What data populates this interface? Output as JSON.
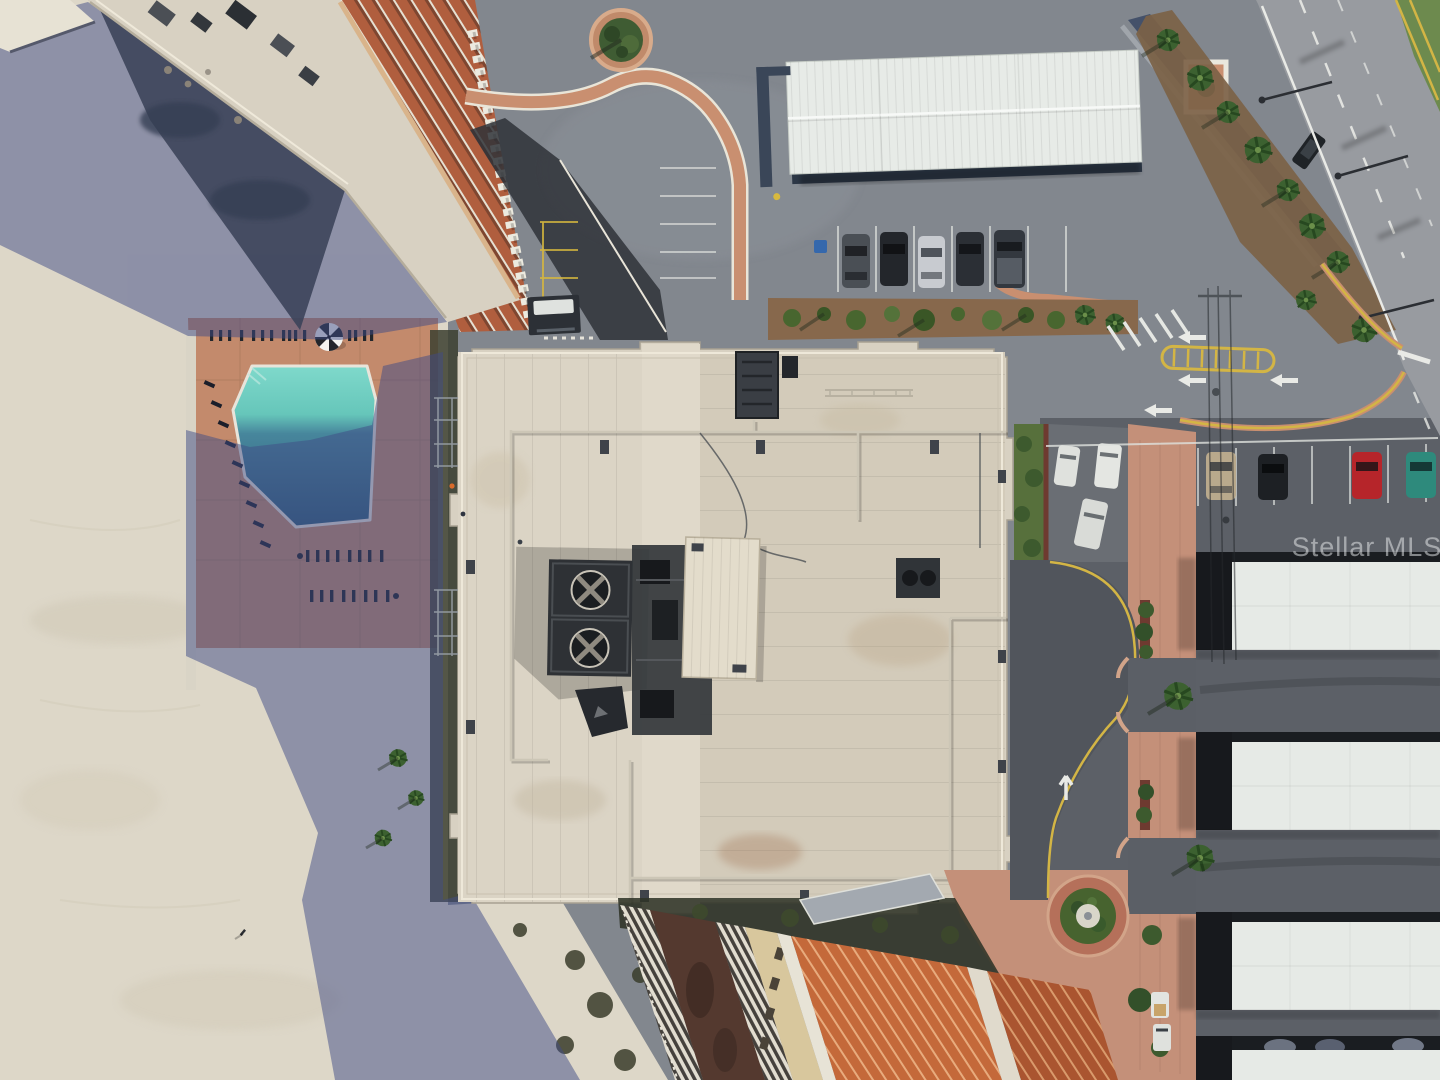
{
  "watermark": {
    "text": "Stellar MLS",
    "color": "#eef0f2"
  },
  "palette": {
    "sand": "#ddd7c8",
    "shadow_blue": "#3f4b85",
    "asphalt": "#82878e",
    "asphalt_dark": "#5c6067",
    "drive_dark": "#51555c",
    "road": "#989ba0",
    "grass": "#6d8a4e",
    "mulch": "#7c6246",
    "landscape_mulch": "#87684c",
    "deck_terracotta": "#c38a6c",
    "pool_shallow": "#7fd9cb",
    "pool_deep": "#2e5c7a",
    "roof_main": "#d8d1c2",
    "roof_right": "#d3cbba",
    "penthouse": "#e3dccb",
    "canopy_white": "#e7ebe7",
    "storage_canopy": "#e6eae6",
    "facade_terracotta": "#b05e3e",
    "tower_beige": "#d8c79d",
    "maroon_deck": "#54392f",
    "wall_blue": "#44516a",
    "plaza_pink": "#c49079",
    "yellow_line": "#d3b545",
    "white_line": "#e9eae6",
    "equipment_dark": "#2e3135"
  },
  "vehicles": {
    "top_row": [
      {
        "type": "suv",
        "color": "#4a4f55"
      },
      {
        "type": "suv",
        "color": "#23262b"
      },
      {
        "type": "sedan",
        "color": "#c8cbd0"
      },
      {
        "type": "suv",
        "color": "#2b2f35"
      },
      {
        "type": "pickup",
        "color": "#33383f"
      }
    ],
    "east_row": [
      {
        "type": "sedan",
        "color": "#b9a98c"
      },
      {
        "type": "sedan",
        "color": "#1d2024"
      },
      {
        "type": "sedan",
        "color": "#b6252a"
      },
      {
        "type": "sedan",
        "color": "#2e8a7c"
      }
    ],
    "small_lot": [
      {
        "color": "#dfe1dd"
      },
      {
        "color": "#e4e6e2"
      },
      {
        "color": "#d9dbd7"
      }
    ],
    "road_car": {
      "color": "#1f2327"
    }
  }
}
